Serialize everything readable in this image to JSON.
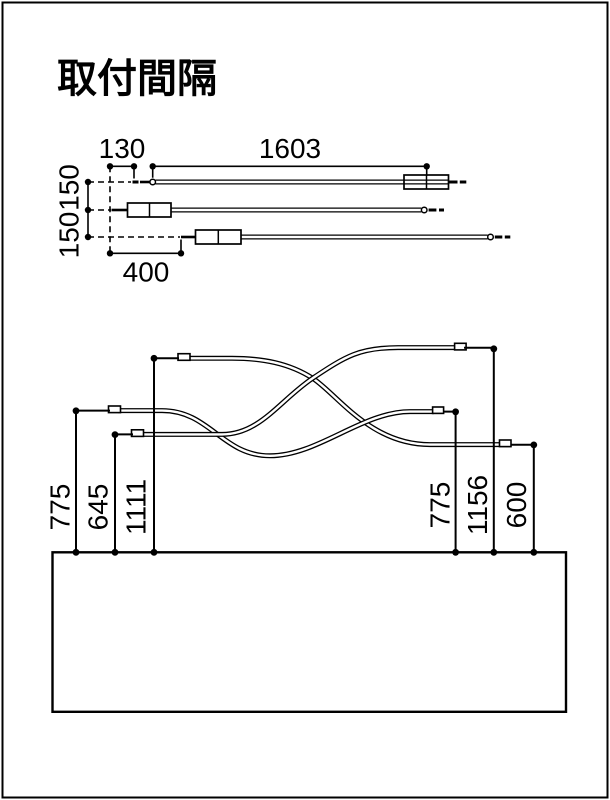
{
  "title": "取付間隔",
  "colors": {
    "ink": "#000000",
    "paper": "#ffffff"
  },
  "top_view": {
    "description": "plan view of three staggered linear fixtures",
    "dim_tip_offset": "130",
    "dim_fixture_length": "1603",
    "dim_row_pitch_a": "150",
    "dim_row_pitch_b": "150",
    "dim_bottom_tip_offset": "400"
  },
  "side_view": {
    "description": "elevation of three curved arms above counter",
    "dim_left_mid_arm": "775",
    "dim_left_low_arm": "645",
    "dim_left_high_arm": "1111",
    "dim_right_mid_arm": "775",
    "dim_right_high_arm": "1156",
    "dim_right_low_arm": "600"
  }
}
